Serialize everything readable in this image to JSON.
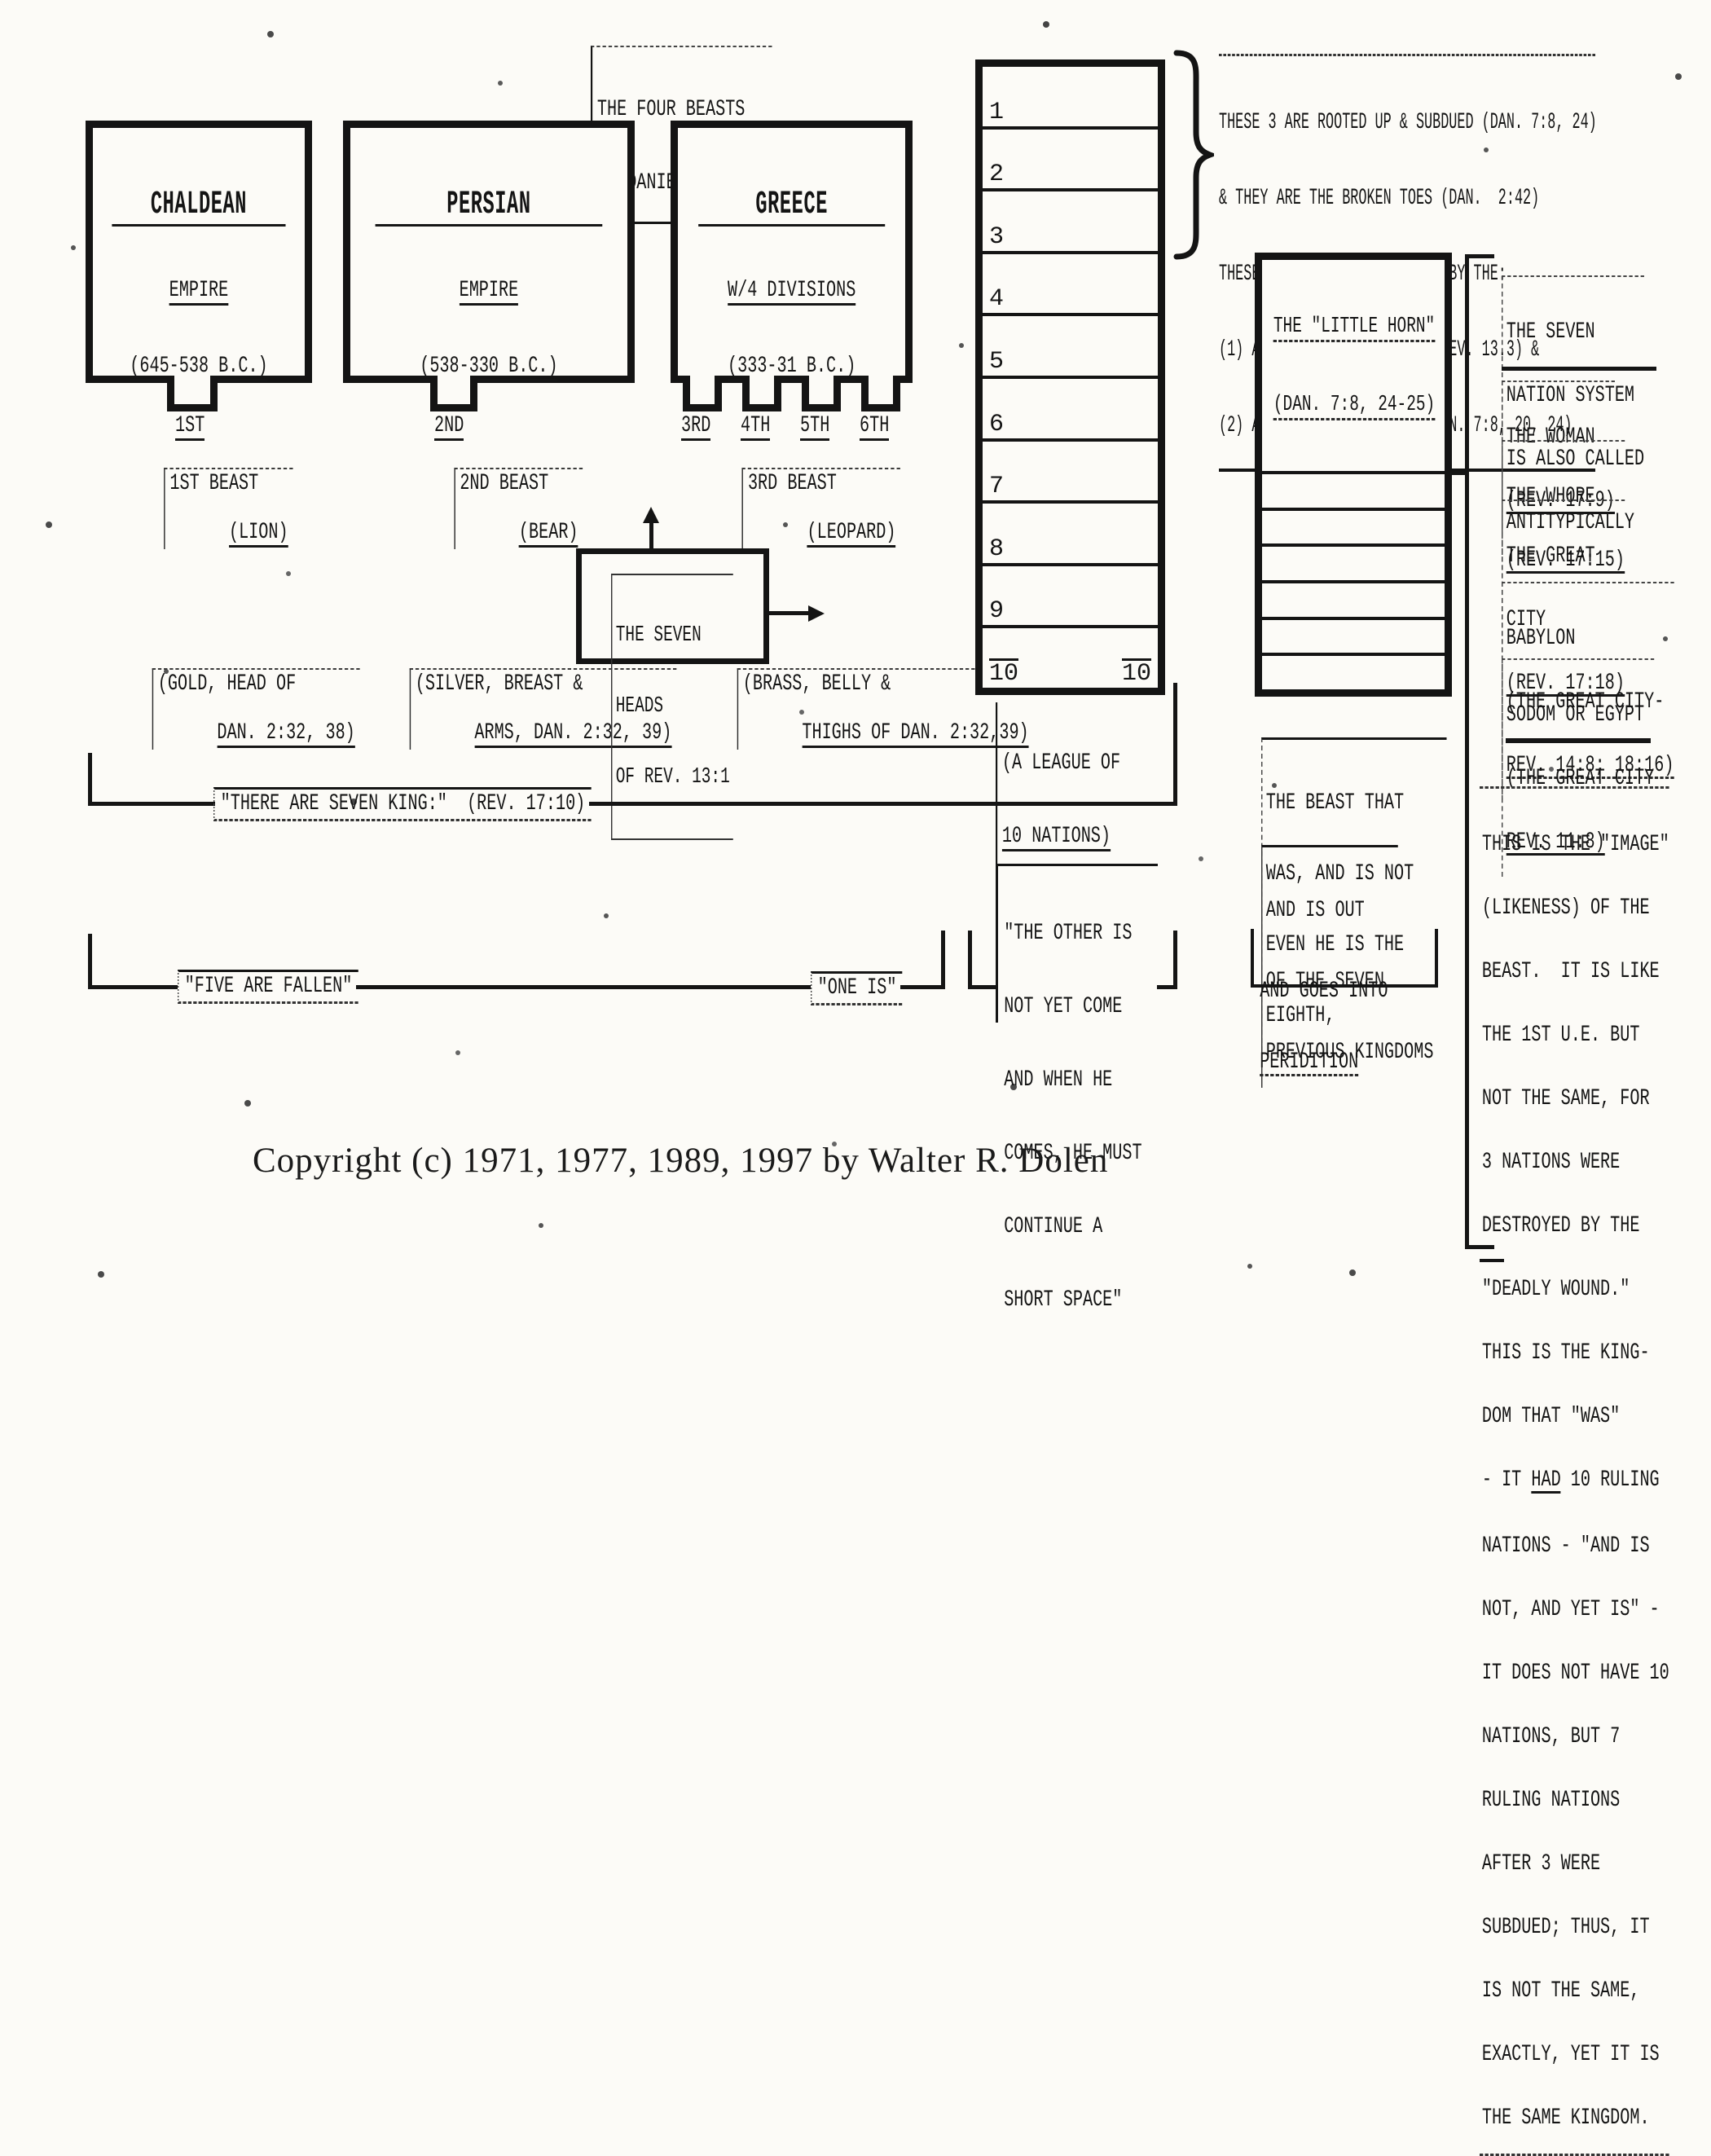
{
  "four_beasts_label": {
    "line1": "THE FOUR BEASTS",
    "line2": "OF DANIEL 7:3-7"
  },
  "empires": [
    {
      "name": "CHALDEAN",
      "sub1": "EMPIRE",
      "sub2": "(645-538 B.C.)",
      "beast1": "1ST BEAST",
      "beast2": "(LION)",
      "body1": "(GOLD, HEAD OF",
      "body2": "DAN. 2:32, 38)",
      "foot1": "1ST"
    },
    {
      "name": "PERSIAN",
      "sub1": "EMPIRE",
      "sub2": "(538-330 B.C.)",
      "beast1": "2ND BEAST",
      "beast2": "(BEAR)",
      "body1": "(SILVER, BREAST &",
      "body2": "ARMS, DAN. 2:32, 39)",
      "foot1": "2ND"
    },
    {
      "name": "GREECE",
      "sub1": "W/4 DIVISIONS",
      "sub2": "(333-31 B.C.)",
      "beast1": "3RD BEAST",
      "beast2": "(LEOPARD)",
      "body1": "(BRASS, BELLY &",
      "body2": "THIGHS OF DAN. 2:32,39)",
      "foot1": "3RD",
      "foot2": "4TH",
      "foot3": "5TH",
      "foot4": "6TH"
    }
  ],
  "ten_nations": {
    "numbers": [
      "1",
      "2",
      "3",
      "4",
      "5",
      "6",
      "7",
      "8",
      "9",
      "10"
    ],
    "last_right": "10",
    "caption1": "(A LEAGUE OF",
    "caption2": "10 NATIONS)"
  },
  "rooted_note": {
    "line1": "THESE 3 ARE ROOTED UP & SUBDUED (DAN. 7:8, 24)",
    "line2": "& THEY ARE THE BROKEN TOES (DAN.  2:42)",
    "line3": "THESE 3 NATIONS ARE REMOVED BY THE:",
    "line4": "(1) ANTITYPE DEADLY WOUND (REV. 13.3) &",
    "line5": "(2) ANTITYPE LITTLE HORN (DAN. 7:8, 20, 24)"
  },
  "little_horn": {
    "title1": "THE \"LITTLE HORN\"",
    "title2": "(DAN. 7:8, 24-25)"
  },
  "seven_nation_intro": {
    "line1": "THE SEVEN",
    "line2": "NATION SYSTEM",
    "line3": "IS ALSO CALLED",
    "line4": "ANTITYPICALLY"
  },
  "aliases": {
    "woman1": "THE WOMAN",
    "woman2": "(REV. 17:9)",
    "whore1": "THE WHORE",
    "whore2": "(REV. 17:15)",
    "city1": "THE GREAT",
    "city2": "CITY",
    "city3": "(REV. 17:18)",
    "babylon1": "BABYLON",
    "babylon2": "(THE GREAT CITY-",
    "babylon3": "REV. 14:8; 18:16)",
    "sodom1": "SODOM OR EGYPT",
    "sodom2": "(THE GREAT CITY",
    "sodom3": "REV. 11:8)"
  },
  "image_note": {
    "l01": "THIS IS THE \"IMAGE\"",
    "l02": "(LIKENESS) OF THE",
    "l03": "BEAST.  IT IS LIKE",
    "l04": "THE 1ST U.E. BUT",
    "l05": "NOT THE SAME, FOR",
    "l06": "3 NATIONS WERE",
    "l07": "DESTROYED BY THE",
    "l08": "\"DEADLY WOUND.\"",
    "l09": "THIS IS THE KING-",
    "l10": "DOM THAT \"WAS\"",
    "had_prefix": "- IT ",
    "had_word": "HAD",
    "had_suffix": " 10 RULING",
    "l12": "NATIONS - \"AND IS",
    "l13": "NOT, AND YET IS\" -",
    "l14": "IT DOES NOT HAVE 10",
    "l15": "NATIONS, BUT 7",
    "l16": "RULING NATIONS",
    "l17": "AFTER 3 WERE",
    "l18": "SUBDUED; THUS, IT",
    "l19": "IS NOT THE SAME,",
    "l20": "EXACTLY, YET IT IS",
    "l21": "THE SAME KINGDOM."
  },
  "seven_heads": {
    "line1": "THE SEVEN",
    "line2": "HEADS",
    "line3": "OF REV. 13:1"
  },
  "beast_eighth": {
    "line1": "THE BEAST THAT",
    "line2": "WAS, AND IS NOT",
    "line3": "EVEN HE IS THE",
    "line4": "EIGHTH,"
  },
  "out_of_seven": {
    "line1": "AND IS OUT",
    "line2": "OF THE SEVEN",
    "line3": "PREVIOUS KINGDOMS"
  },
  "perdition": {
    "line1": "AND GOES INTO",
    "line2": "PERIDITION"
  },
  "kings_line": {
    "label": "\"THERE ARE SEVEN KING:\"  (REV. 17:10)"
  },
  "fallen_line": {
    "label": "\"FIVE ARE FALLEN\"",
    "one_is": "\"ONE IS\""
  },
  "other_quote": {
    "line1": "\"THE OTHER IS",
    "line2": "NOT YET COME",
    "line3": "AND WHEN HE",
    "line4": "COMES, HE MUST",
    "line5": "CONTINUE A",
    "line6": "SHORT SPACE\""
  },
  "copyright": "Copyright (c) 1971, 1977, 1989, 1997 by Walter R. Dolen"
}
